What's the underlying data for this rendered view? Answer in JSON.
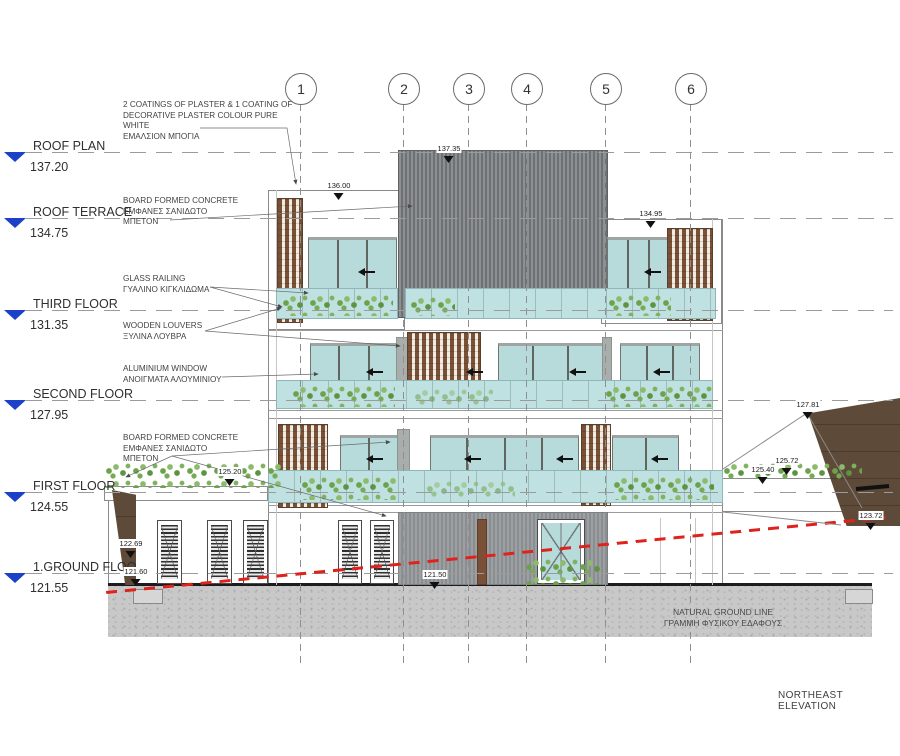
{
  "drawing": {
    "name": "NORTHEAST ELEVATION"
  },
  "levels": [
    {
      "label": "ROOF PLAN",
      "value": "137.20"
    },
    {
      "label": "ROOF TERRACE",
      "value": "134.75"
    },
    {
      "label": "THIRD FLOOR",
      "value": "131.35"
    },
    {
      "label": "SECOND FLOOR",
      "value": "127.95"
    },
    {
      "label": "FIRST FLOOR",
      "value": "124.55"
    },
    {
      "label": "1.GROUND FLOO.",
      "value": "121.55"
    }
  ],
  "grids": [
    "1",
    "2",
    "3",
    "4",
    "5",
    "6"
  ],
  "annotations": {
    "plaster": [
      "2 COATINGS OF PLASTER & 1 COATING OF",
      "DECORATIVE PLASTER COLOUR PURE",
      "WHITE",
      "ΕΜΑΛΣΙΟΝ ΜΠΟΓΙΑ"
    ],
    "concrete_upper": [
      "BOARD FORMED CONCRETE",
      "ΕΜΦΑΝΕΣ ΣΑΝΙΔΩΤΟ",
      "ΜΠΕΤΟΝ"
    ],
    "glass_railing": [
      "GLASS RAILING",
      "ΓΥΑΛΙΝΟ ΚΙΓΚΛΙΔΩΜΑ"
    ],
    "wooden_louvers": [
      "WOODEN LOUVERS",
      "ΞΥΛΙΝΑ ΛΟΥΒΡΑ"
    ],
    "aluminium_window": [
      "ALUMINIUM WINDOW",
      "ΑΝΟΙΓΜΑΤΑ ΑΛΟΥΜΙΝΙΟΥ"
    ],
    "concrete_lower": [
      "BOARD FORMED CONCRETE",
      "ΕΜΦΑΝΕΣ ΣΑΝΙΔΩΤΟ",
      "ΜΠΕΤΟΝ"
    ],
    "natural_ground": [
      "NATURAL GROUND LINE",
      "ΓΡΑΜΜΗ ΦΥΣΙΚΟΥ ΕΔΑΦΟΥΣ"
    ]
  },
  "spots": {
    "roof_top": "137.35",
    "left_parapet": "136.00",
    "right_parapet": "134.95",
    "ramp_top": "127.81",
    "planter_right_high": "125.72",
    "planter_right_low": "125.40",
    "planter_left": "125.20",
    "wall_right": "123.72",
    "earth_left_high": "122.69",
    "earth_left_low": "121.60",
    "ground_slab": "121.50"
  },
  "colors": {
    "level_marker_blue": "#1b41c9",
    "ground_line_red": "#dd231b",
    "glass_teal": "#b7dbdb",
    "railing_teal": "#c0e1e1",
    "louver_brown": "#7a5136",
    "cladding_gray": "#7c7f82",
    "earth_brown": "#5e4a38",
    "plant_green": "#6ca24b"
  }
}
